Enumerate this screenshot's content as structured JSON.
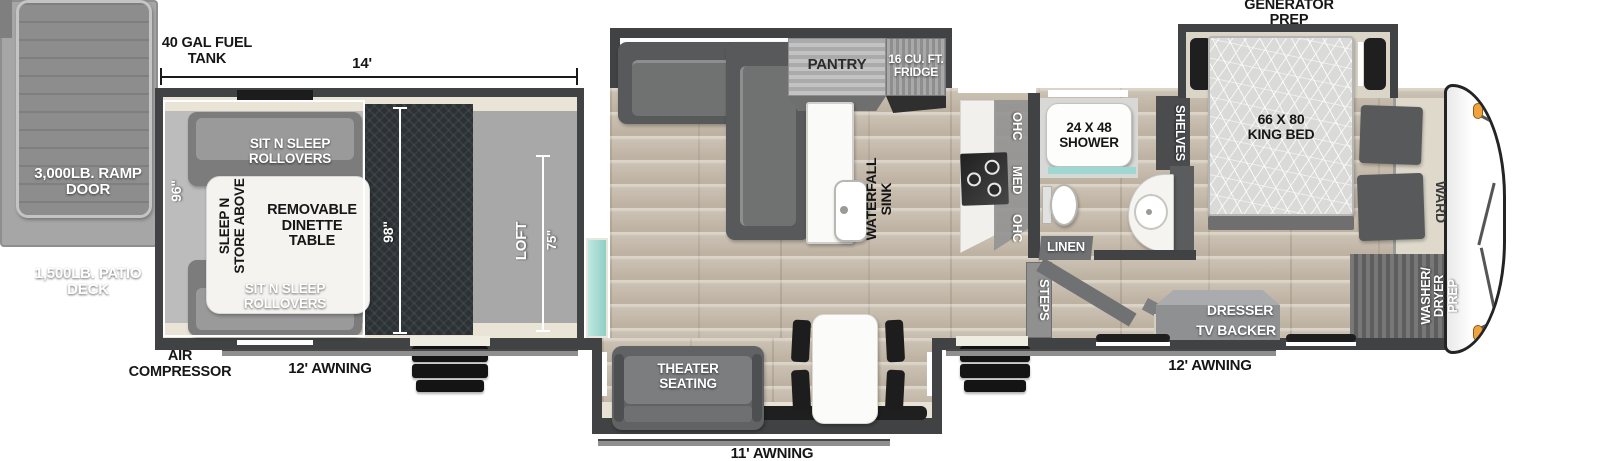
{
  "colors": {
    "wall": "#404243",
    "wood_floor": "#cbc1b2",
    "garage_floor": "#bcbcbc",
    "ramp_floor": "#2b3134",
    "slide_floor": "#e7e2d3",
    "accent_teal": "#9ed8d2",
    "marker_orange": "#f2a23c"
  },
  "exterior": {
    "generator_prep": "GENERATOR PREP",
    "fuel_tank": "40 GAL FUEL TANK",
    "length_dim": "14'",
    "air_compressor": "AIR COMPRESSOR",
    "awning_left": "12' AWNING",
    "awning_center": "11' AWNING",
    "awning_right": "12' AWNING",
    "ramp_door": "3,000LB. RAMP DOOR",
    "patio_deck": "1,500LB. PATIO DECK"
  },
  "garage": {
    "width_dim": "96\"",
    "ramp_dim": "98\"",
    "loft_dim": "75\"",
    "loft": "LOFT",
    "rollover_top": "SIT N SLEEP ROLLOVERS",
    "rollover_bottom": "SIT N SLEEP ROLLOVERS",
    "sleep_n_store": "SLEEP N STORE ABOVE",
    "dinette_table": "REMOVABLE DINETTE TABLE"
  },
  "living": {
    "pantry": "PANTRY",
    "fridge": "16 CU. FT. FRIDGE",
    "sink": "WATERFALL SINK",
    "theater": "THEATER SEATING"
  },
  "kitchen": {
    "ohc_upper": "OHC",
    "med": "MED",
    "ohc_lower": "OHC"
  },
  "bathroom": {
    "shower": "24 X 48 SHOWER",
    "linen": "LINEN",
    "shelves": "SHELVES",
    "steps": "STEPS"
  },
  "bedroom": {
    "king_bed": "66 X 80 KING BED",
    "ward": "WARD",
    "washer_dryer": "WASHER/ DRYER PREP",
    "dresser": "DRESSER",
    "tv_backer": "TV BACKER"
  }
}
